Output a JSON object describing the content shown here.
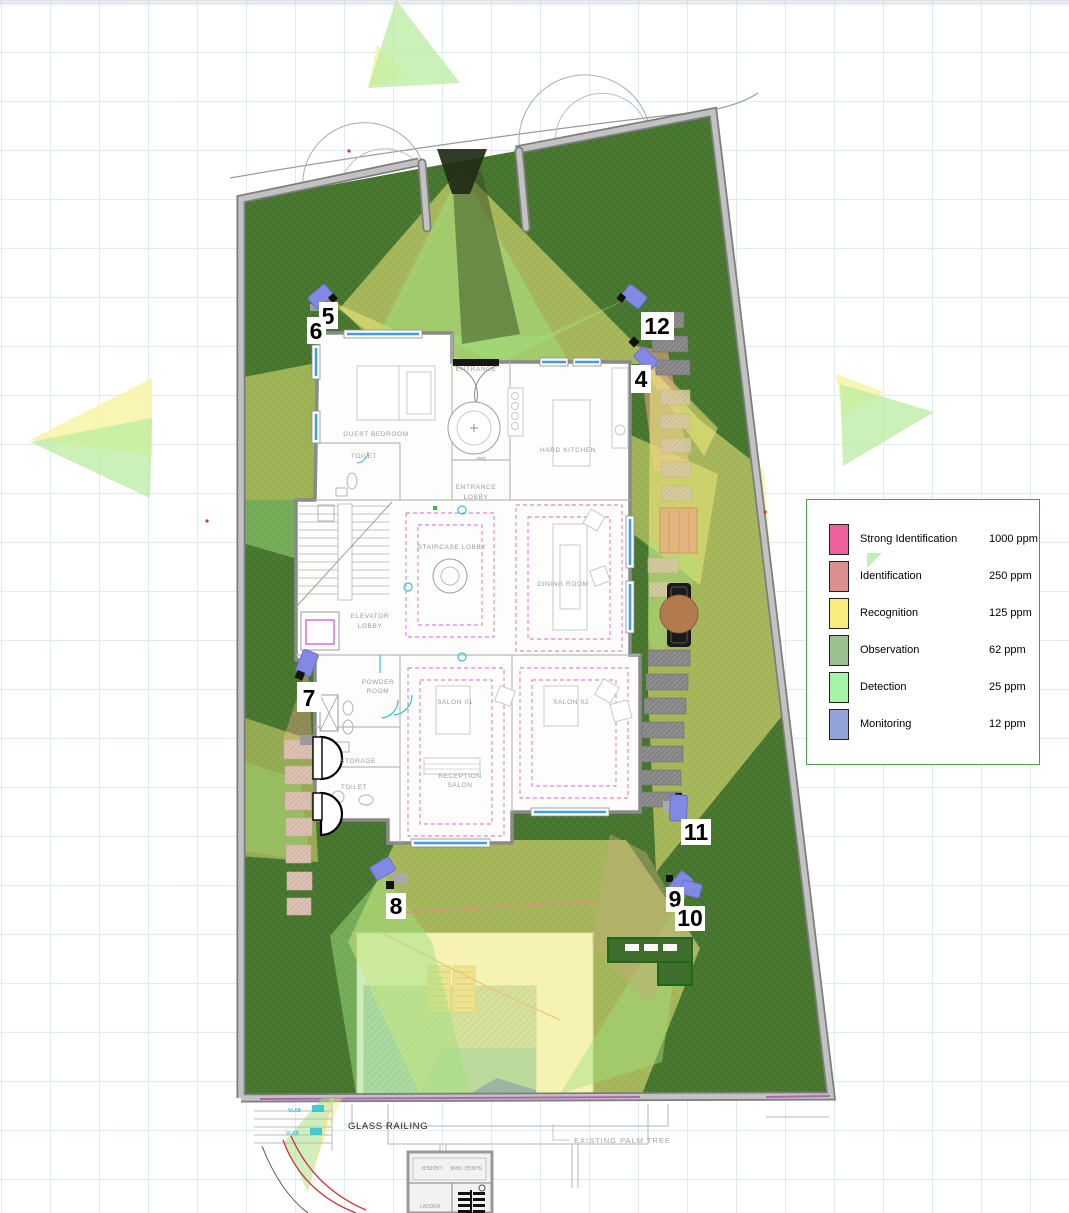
{
  "legend": {
    "rows": [
      {
        "label": "Strong Identification",
        "ppm": "1000 ppm",
        "color": "#f0609d"
      },
      {
        "label": "Identification",
        "ppm": "250 ppm",
        "color": "#dd8f8f"
      },
      {
        "label": "Recognition",
        "ppm": "125 ppm",
        "color": "#f9ee7d"
      },
      {
        "label": "Observation",
        "ppm": "62 ppm",
        "color": "#9cc08e"
      },
      {
        "label": "Detection",
        "ppm": "25 ppm",
        "color": "#a6f2a6"
      },
      {
        "label": "Monitoring",
        "ppm": "12 ppm",
        "color": "#93a2d8"
      }
    ]
  },
  "cameras": [
    {
      "label": "5"
    },
    {
      "label": "6"
    },
    {
      "label": "12"
    },
    {
      "label": "4"
    },
    {
      "label": "7"
    },
    {
      "label": "8"
    },
    {
      "label": "11"
    },
    {
      "label": "9"
    },
    {
      "label": "10"
    }
  ],
  "rooms": [
    {
      "label": "GUEST BEDROOM"
    },
    {
      "label": "TOILET"
    },
    {
      "label": "ENTRANCE"
    },
    {
      "label": "ENTRANCE"
    },
    {
      "label": "LOBBY"
    },
    {
      "label": "HARD KITCHEN"
    },
    {
      "label": "STAIRCASE LOBBY"
    },
    {
      "label": "DINING ROOM"
    },
    {
      "label": "ELEVATOR"
    },
    {
      "label": "LOBBY"
    },
    {
      "label": "POWDER"
    },
    {
      "label": "ROOM"
    },
    {
      "label": "SALON 01"
    },
    {
      "label": "SALON 02"
    },
    {
      "label": "STORAGE"
    },
    {
      "label": "TOILET"
    },
    {
      "label": "RECEPTION"
    },
    {
      "label": "SALON"
    },
    {
      "label": "step"
    }
  ],
  "annotations": {
    "glass_railing": "GLASS RAILING",
    "palm_tree": "EXISTING PALM TREE",
    "ladder": "LADDER",
    "surge_tank": "SURGE TANK",
    "ladder_small": "LADDER",
    "vlxb1": "VLXB",
    "vlxb2": "VLXB"
  },
  "colors": {
    "lawn": "#4a7a31",
    "cone_yellow": "#f3eb7e",
    "cone_green": "#9fe07f",
    "cone_salmon": "#e8a38b",
    "camera_body": "#8289e4",
    "wall": "#8c8c8c",
    "window_glass": "#3f9fe0",
    "rug_dash": "#d667c8",
    "water": "#b7d3c0"
  }
}
